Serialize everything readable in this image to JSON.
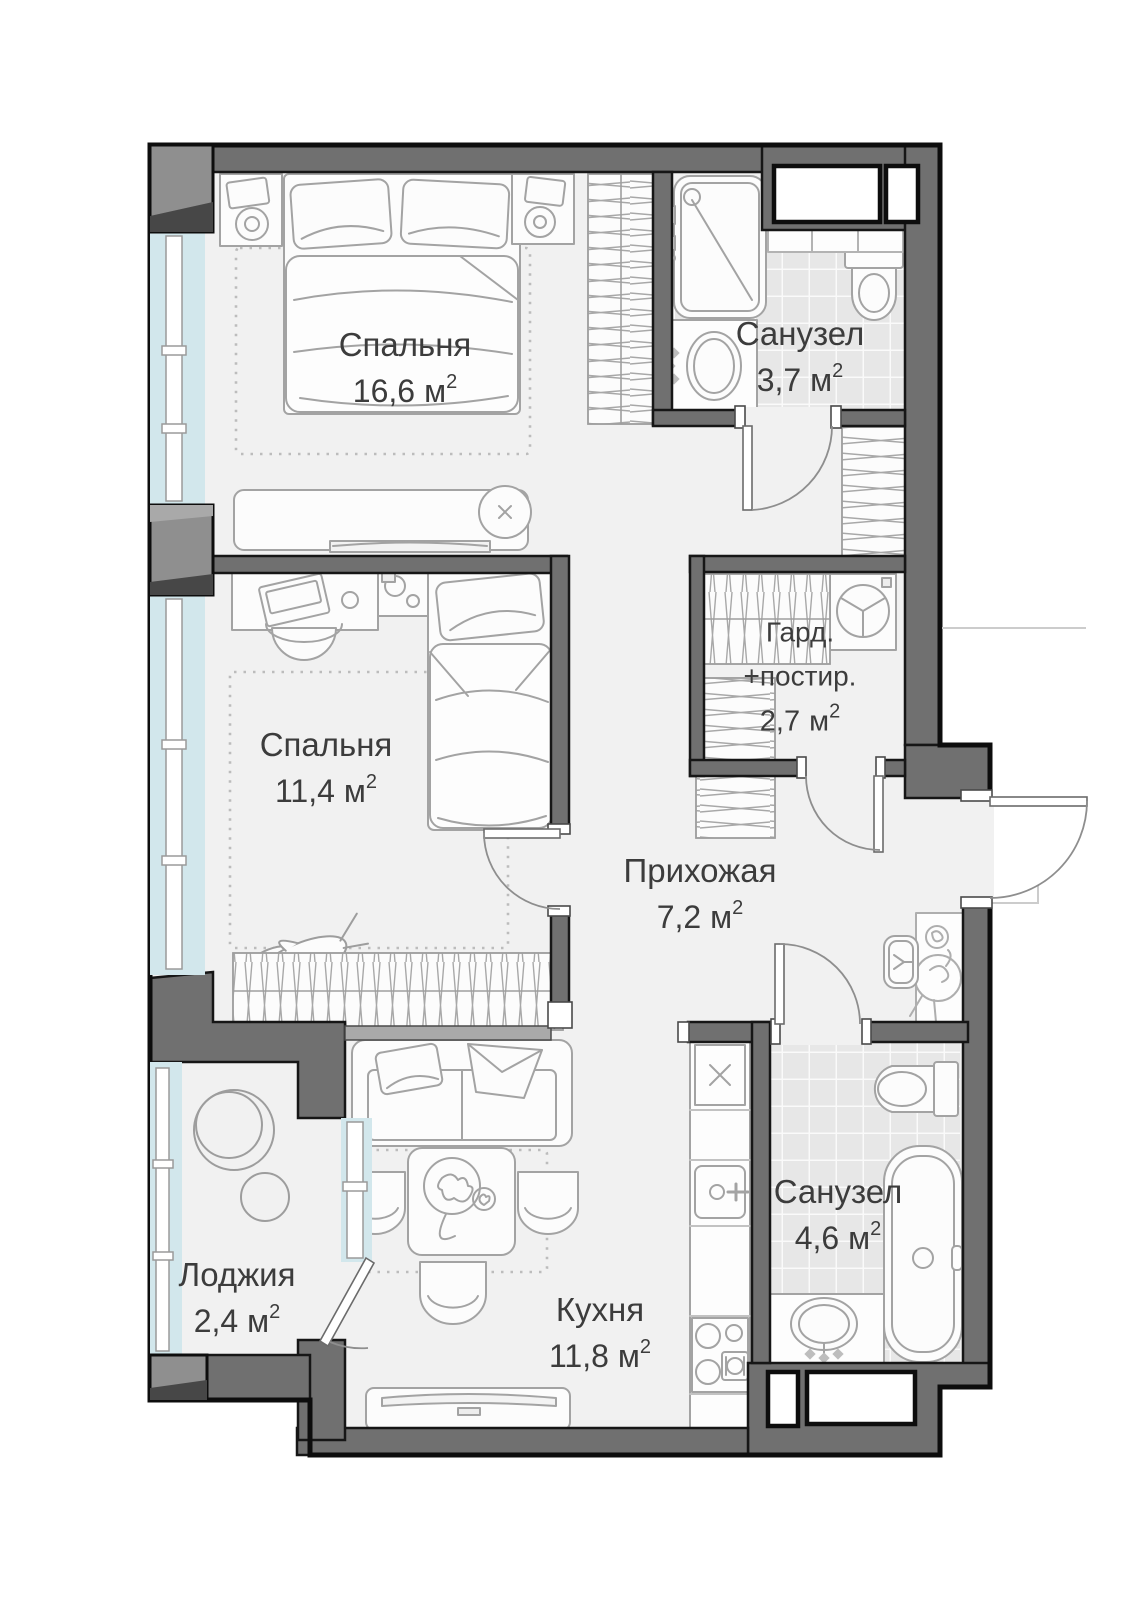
{
  "plan": {
    "rooms": [
      {
        "id": "bedroom-1",
        "name": "Спальня",
        "area": "16,6"
      },
      {
        "id": "bathroom-1",
        "name": "Санузел",
        "area": "3,7"
      },
      {
        "id": "wardrobe-laundry",
        "name_line1": "Гард.",
        "name_line2": "+постир.",
        "area": "2,7"
      },
      {
        "id": "bedroom-2",
        "name": "Спальня",
        "area": "11,4"
      },
      {
        "id": "hallway",
        "name": "Прихожая",
        "area": "7,2"
      },
      {
        "id": "loggia",
        "name": "Лоджия",
        "area": "2,4"
      },
      {
        "id": "kitchen",
        "name": "Кухня",
        "area": "11,8"
      },
      {
        "id": "bathroom-2",
        "name": "Санузел",
        "area": "4,6"
      }
    ],
    "area_unit": "м",
    "area_superscript": "2"
  },
  "colors": {
    "background": "#ffffff",
    "floor": "#f1f1f1",
    "wall": "#707070",
    "wall_outline": "#0d0d0d",
    "pillar": "#8f8f8f",
    "pillar_bevel": "#474747",
    "tile_floor": "#e7e7e7",
    "window_glazing": "#d2e7ec",
    "furniture_line": "#a3a3a3",
    "label_text": "#3c3c3c"
  }
}
